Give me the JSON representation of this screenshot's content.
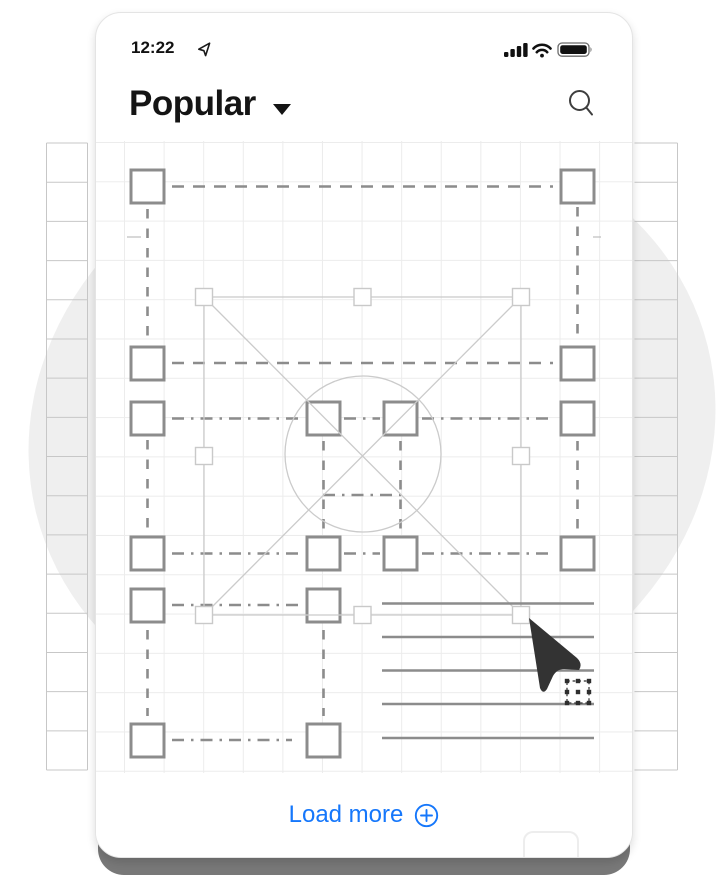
{
  "status_bar": {
    "time": "12:22",
    "icons": [
      "location-arrow-icon",
      "signal-icon",
      "wifi-icon",
      "battery-icon"
    ]
  },
  "header": {
    "title": "Popular",
    "has_dropdown": true,
    "icons": [
      "caret-down-icon",
      "search-icon"
    ]
  },
  "footer": {
    "load_more_label": "Load more",
    "icon": "plus-circle-icon"
  },
  "colors": {
    "accent_blue": "#1577FB",
    "blob_gray": "#EFEFEF",
    "wire_dark": "#8C8C8C",
    "wire_light": "#CBCBCB",
    "handle_border": "#C9C9C9",
    "cursor_dark": "#333333",
    "canvas_grid": "#ECECEC",
    "outer_grid": "#C7C7C7",
    "card_shadow_bar": "#787878",
    "text_dark": "#111111"
  },
  "background": {
    "blob": {
      "cx": 372,
      "cy": 430,
      "rx": 346,
      "ry": 300,
      "rotate": -14,
      "fill": "#EFEFEF"
    },
    "strips": {
      "y0": 143,
      "y1": 770,
      "rows": 17,
      "left": [
        46.5,
        87.5
      ],
      "right": [
        634.5,
        677.5
      ],
      "color": "#C7C7C7"
    }
  },
  "illustration": {
    "square_size": 33,
    "squares": [
      [
        35,
        29
      ],
      [
        465,
        29
      ],
      [
        35,
        206
      ],
      [
        465,
        206
      ],
      [
        35,
        261
      ],
      [
        211,
        261
      ],
      [
        288,
        261
      ],
      [
        465,
        261
      ],
      [
        35,
        396
      ],
      [
        211,
        396
      ],
      [
        288,
        396
      ],
      [
        465,
        396
      ],
      [
        35,
        448
      ],
      [
        211,
        448
      ],
      [
        35,
        583
      ],
      [
        211,
        583
      ]
    ],
    "dash_h": [
      {
        "y": 45.5,
        "style": "dash",
        "segs": [
          [
            76,
            457
          ]
        ]
      },
      {
        "y": 222,
        "style": "dash",
        "segs": [
          [
            76,
            457
          ]
        ]
      },
      {
        "y": 277.5,
        "style": "dashdot",
        "segs": [
          [
            76,
            207
          ],
          [
            248,
            284
          ],
          [
            326,
            457
          ]
        ]
      },
      {
        "y": 354,
        "style": "dashdot",
        "segs": [
          [
            227,
            305
          ]
        ]
      },
      {
        "y": 412.5,
        "style": "dashdot",
        "segs": [
          [
            76,
            207
          ],
          [
            248,
            284
          ],
          [
            326,
            457
          ]
        ]
      },
      {
        "y": 464,
        "style": "dashdot",
        "segs": [
          [
            76,
            207
          ]
        ]
      },
      {
        "y": 599,
        "style": "dashdot",
        "segs": [
          [
            76,
            196
          ]
        ]
      }
    ],
    "dash_v": [
      {
        "x": 51.5,
        "segs": [
          [
            68,
            198
          ],
          [
            299,
            388
          ],
          [
            489,
            575
          ]
        ]
      },
      {
        "x": 481.5,
        "segs": [
          [
            66,
            198
          ],
          [
            300,
            388
          ]
        ]
      },
      {
        "x": 227.5,
        "segs": [
          [
            300,
            388
          ],
          [
            489,
            575
          ]
        ]
      },
      {
        "x": 304.5,
        "segs": [
          [
            300,
            388
          ]
        ]
      }
    ],
    "selection": {
      "x1": 108,
      "y1": 156,
      "x2": 425,
      "y2": 474,
      "handle_size": 17
    },
    "circle": {
      "cx": 267,
      "cy": 313,
      "r": 78
    },
    "text_lines": {
      "x1": 286,
      "x2": 498,
      "ys": [
        462.5,
        496,
        529.5,
        563,
        597
      ]
    },
    "ticks": [
      [
        31,
        96,
        45,
        96
      ],
      [
        497,
        96,
        505,
        96
      ]
    ],
    "cursor_path": "M433 477 L481 517 Q487 523 483 529 L468 528 Q461 528 457 535 L451 548 Q447 554 444 547 Z",
    "dotted_box": {
      "x": 471,
      "y": 540,
      "size": 22
    }
  }
}
